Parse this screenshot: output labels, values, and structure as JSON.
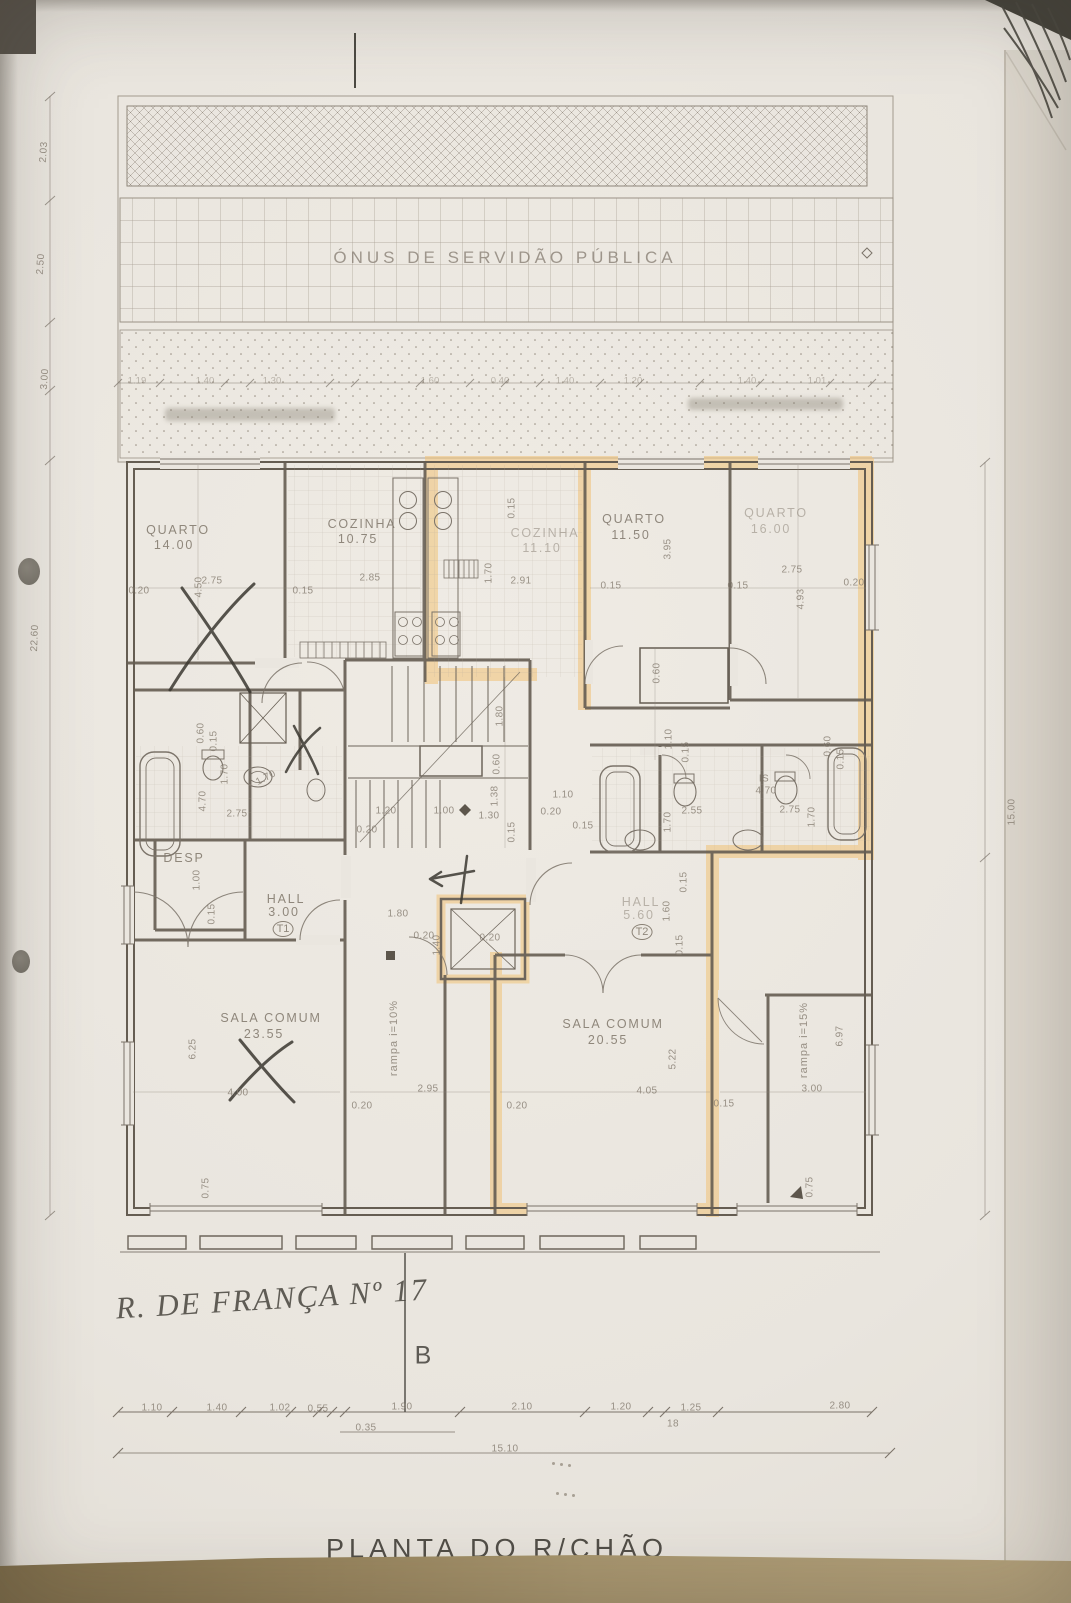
{
  "document": {
    "title": "PLANTA DO R/CHÃO",
    "servitude_band": "ÓNUS DE SERVIDÃO PÚBLICA",
    "handwritten_note": "R. DE FRANÇA Nº 17",
    "section_letter": "B"
  },
  "colors": {
    "highlight": "#f1c277",
    "wall": "#655d52",
    "ink": "#7a7166",
    "pen": "#3b3831",
    "paper": "#eae6df",
    "desk": "#a7946c"
  },
  "plan": {
    "labels": [
      {
        "text": "QUARTO",
        "x": 178,
        "y": 530,
        "cls": "room",
        "name": "room-label-quarto-1"
      },
      {
        "text": "14.00",
        "x": 174,
        "y": 545,
        "cls": "room",
        "name": "room-area-quarto-1"
      },
      {
        "text": "COZINHA",
        "x": 362,
        "y": 524,
        "cls": "room",
        "name": "room-label-cozinha-1"
      },
      {
        "text": "10.75",
        "x": 358,
        "y": 539,
        "cls": "room",
        "name": "room-area-cozinha-1"
      },
      {
        "text": "COZINHA",
        "x": 545,
        "y": 533,
        "cls": "roomf",
        "name": "room-label-cozinha-2"
      },
      {
        "text": "11.10",
        "x": 542,
        "y": 548,
        "cls": "roomf",
        "name": "room-area-cozinha-2"
      },
      {
        "text": "QUARTO",
        "x": 634,
        "y": 519,
        "cls": "room",
        "name": "room-label-quarto-2"
      },
      {
        "text": "11.50",
        "x": 631,
        "y": 535,
        "cls": "room",
        "name": "room-area-quarto-2"
      },
      {
        "text": "QUARTO",
        "x": 776,
        "y": 513,
        "cls": "roomf",
        "name": "room-label-quarto-3"
      },
      {
        "text": "16.00",
        "x": 771,
        "y": 529,
        "cls": "roomf",
        "name": "room-area-quarto-3"
      },
      {
        "text": "DESP",
        "x": 184,
        "y": 858,
        "cls": "room",
        "name": "room-label-desp"
      },
      {
        "text": "HALL",
        "x": 286,
        "y": 899,
        "cls": "room",
        "name": "room-label-hall-t1"
      },
      {
        "text": "3.00",
        "x": 284,
        "y": 912,
        "cls": "room",
        "name": "room-area-hall-t1"
      },
      {
        "text": "T1",
        "x": 283,
        "y": 929,
        "cls": "circ",
        "name": "unit-badge-t1"
      },
      {
        "text": "HALL",
        "x": 641,
        "y": 902,
        "cls": "roomf",
        "name": "room-label-hall-t2"
      },
      {
        "text": "5.60",
        "x": 639,
        "y": 915,
        "cls": "roomf",
        "name": "room-area-hall-t2"
      },
      {
        "text": "T2",
        "x": 642,
        "y": 932,
        "cls": "circ",
        "name": "unit-badge-t2"
      },
      {
        "text": "SALA COMUM",
        "x": 271,
        "y": 1018,
        "cls": "room",
        "name": "room-label-sala-1"
      },
      {
        "text": "23.55",
        "x": 264,
        "y": 1034,
        "cls": "room",
        "name": "room-area-sala-1"
      },
      {
        "text": "SALA COMUM",
        "x": 613,
        "y": 1024,
        "cls": "room",
        "name": "room-label-sala-2"
      },
      {
        "text": "20.55",
        "x": 608,
        "y": 1040,
        "cls": "room",
        "name": "room-area-sala-2"
      },
      {
        "text": "IS",
        "x": 764,
        "y": 779,
        "cls": "dim",
        "name": "room-label-is"
      },
      {
        "text": "4.70",
        "x": 766,
        "y": 791,
        "cls": "dim",
        "name": "room-area-is"
      },
      {
        "text": "rampa i=10%",
        "x": 394,
        "y": 1038,
        "rot": -90,
        "cls": "ramp",
        "name": "ramp-label-left"
      },
      {
        "text": "rampa i=15%",
        "x": 804,
        "y": 1040,
        "rot": -90,
        "cls": "ramp",
        "name": "ramp-label-right"
      },
      {
        "text": "2.03",
        "x": 44,
        "y": 152,
        "rot": -86,
        "cls": "dim"
      },
      {
        "text": "2.50",
        "x": 41,
        "y": 264,
        "rot": -86,
        "cls": "dim"
      },
      {
        "text": "3.00",
        "x": 45,
        "y": 379,
        "rot": -86,
        "cls": "dim"
      },
      {
        "text": "22.60",
        "x": 35,
        "y": 638,
        "rot": -88,
        "cls": "dim"
      },
      {
        "text": "15.00",
        "x": 1012,
        "y": 812,
        "rot": -90,
        "cls": "dim"
      },
      {
        "text": "1.19",
        "x": 137,
        "y": 381,
        "cls": "dimf"
      },
      {
        "text": "1.40",
        "x": 205,
        "y": 381,
        "cls": "dimf"
      },
      {
        "text": "1.30",
        "x": 272,
        "y": 381,
        "cls": "dimf"
      },
      {
        "text": "1.60",
        "x": 430,
        "y": 381,
        "cls": "dimf"
      },
      {
        "text": "0.40",
        "x": 500,
        "y": 381,
        "cls": "dimf"
      },
      {
        "text": "1.40",
        "x": 565,
        "y": 381,
        "cls": "dimf"
      },
      {
        "text": "1.20",
        "x": 633,
        "y": 381,
        "cls": "dimf"
      },
      {
        "text": "1.40",
        "x": 747,
        "y": 381,
        "cls": "dimf"
      },
      {
        "text": "1.01",
        "x": 817,
        "y": 381,
        "cls": "dimf"
      },
      {
        "text": "0.20",
        "x": 139,
        "y": 591,
        "cls": "dim"
      },
      {
        "text": "4.50",
        "x": 199,
        "y": 587,
        "rot": -90,
        "cls": "dim"
      },
      {
        "text": "2.75",
        "x": 212,
        "y": 581,
        "cls": "dim"
      },
      {
        "text": "0.15",
        "x": 303,
        "y": 591,
        "cls": "dim"
      },
      {
        "text": "2.85",
        "x": 370,
        "y": 578,
        "cls": "dim"
      },
      {
        "text": "1.70",
        "x": 489,
        "y": 573,
        "rot": -90,
        "cls": "dim"
      },
      {
        "text": "2.91",
        "x": 521,
        "y": 581,
        "cls": "dim"
      },
      {
        "text": "0.15",
        "x": 512,
        "y": 508,
        "rot": -90,
        "cls": "dim"
      },
      {
        "text": "0.15",
        "x": 611,
        "y": 586,
        "cls": "dim"
      },
      {
        "text": "3.95",
        "x": 668,
        "y": 549,
        "rot": -90,
        "cls": "dim"
      },
      {
        "text": "2.75",
        "x": 792,
        "y": 570,
        "cls": "dim"
      },
      {
        "text": "0.15",
        "x": 738,
        "y": 586,
        "cls": "dim"
      },
      {
        "text": "4.93",
        "x": 801,
        "y": 599,
        "rot": -90,
        "cls": "dim"
      },
      {
        "text": "0.20",
        "x": 854,
        "y": 583,
        "cls": "dim"
      },
      {
        "text": "0.60",
        "x": 657,
        "y": 673,
        "rot": -90,
        "cls": "dim"
      },
      {
        "text": "1.10",
        "x": 669,
        "y": 739,
        "rot": -90,
        "cls": "dim"
      },
      {
        "text": "0.15",
        "x": 686,
        "y": 752,
        "rot": -90,
        "cls": "dim"
      },
      {
        "text": "0.60",
        "x": 201,
        "y": 733,
        "rot": -90,
        "cls": "dim"
      },
      {
        "text": "0.15",
        "x": 214,
        "y": 741,
        "rot": -90,
        "cls": "dim"
      },
      {
        "text": "1.70",
        "x": 225,
        "y": 774,
        "rot": -90,
        "cls": "dim"
      },
      {
        "text": "1.70",
        "x": 266,
        "y": 778,
        "rot": -28,
        "cls": "dim"
      },
      {
        "text": "4.70",
        "x": 203,
        "y": 801,
        "rot": -90,
        "cls": "dim"
      },
      {
        "text": "2.75",
        "x": 237,
        "y": 814,
        "cls": "dim"
      },
      {
        "text": "1.00",
        "x": 197,
        "y": 880,
        "rot": -90,
        "cls": "dim"
      },
      {
        "text": "0.15",
        "x": 212,
        "y": 914,
        "rot": -90,
        "cls": "dim"
      },
      {
        "text": "1.80",
        "x": 500,
        "y": 716,
        "rot": -90,
        "cls": "dim"
      },
      {
        "text": "0.60",
        "x": 497,
        "y": 764,
        "rot": -90,
        "cls": "dim"
      },
      {
        "text": "1.38",
        "x": 495,
        "y": 796,
        "rot": -90,
        "cls": "dim"
      },
      {
        "text": "0.15",
        "x": 512,
        "y": 832,
        "rot": -90,
        "cls": "dim"
      },
      {
        "text": "1.20",
        "x": 386,
        "y": 811,
        "cls": "dim"
      },
      {
        "text": "1.00",
        "x": 444,
        "y": 811,
        "cls": "dim"
      },
      {
        "text": "1.30",
        "x": 489,
        "y": 816,
        "cls": "dim"
      },
      {
        "text": "0.20",
        "x": 367,
        "y": 830,
        "cls": "dim"
      },
      {
        "text": "1.80",
        "x": 398,
        "y": 914,
        "cls": "dim"
      },
      {
        "text": "0.20",
        "x": 424,
        "y": 936,
        "cls": "dim"
      },
      {
        "text": "1.40",
        "x": 437,
        "y": 945,
        "rot": -90,
        "cls": "dim"
      },
      {
        "text": "0.20",
        "x": 490,
        "y": 938,
        "cls": "dim"
      },
      {
        "text": "1.10",
        "x": 563,
        "y": 795,
        "cls": "dim"
      },
      {
        "text": "0.20",
        "x": 551,
        "y": 812,
        "cls": "dim"
      },
      {
        "text": "2.55",
        "x": 692,
        "y": 811,
        "cls": "dim"
      },
      {
        "text": "1.70",
        "x": 668,
        "y": 822,
        "rot": -90,
        "cls": "dim"
      },
      {
        "text": "0.15",
        "x": 583,
        "y": 826,
        "cls": "dim"
      },
      {
        "text": "2.75",
        "x": 790,
        "y": 810,
        "cls": "dim"
      },
      {
        "text": "1.70",
        "x": 812,
        "y": 817,
        "rot": -90,
        "cls": "dim"
      },
      {
        "text": "0.60",
        "x": 828,
        "y": 746,
        "rot": -90,
        "cls": "dim"
      },
      {
        "text": "0.15",
        "x": 841,
        "y": 759,
        "rot": -90,
        "cls": "dim"
      },
      {
        "text": "1.60",
        "x": 667,
        "y": 911,
        "rot": -90,
        "cls": "dim"
      },
      {
        "text": "0.15",
        "x": 684,
        "y": 882,
        "rot": -90,
        "cls": "dim"
      },
      {
        "text": "0.15",
        "x": 680,
        "y": 945,
        "rot": -90,
        "cls": "dim"
      },
      {
        "text": "6.25",
        "x": 193,
        "y": 1049,
        "rot": -90,
        "cls": "dim"
      },
      {
        "text": "4.00",
        "x": 238,
        "y": 1093,
        "cls": "dim"
      },
      {
        "text": "0.75",
        "x": 206,
        "y": 1188,
        "rot": -90,
        "cls": "dim"
      },
      {
        "text": "2.95",
        "x": 428,
        "y": 1089,
        "cls": "dim"
      },
      {
        "text": "0.20",
        "x": 362,
        "y": 1106,
        "cls": "dim"
      },
      {
        "text": "5.22",
        "x": 673,
        "y": 1059,
        "rot": -90,
        "cls": "dim"
      },
      {
        "text": "4.05",
        "x": 647,
        "y": 1091,
        "cls": "dim"
      },
      {
        "text": "0.20",
        "x": 517,
        "y": 1106,
        "cls": "dim"
      },
      {
        "text": "0.15",
        "x": 724,
        "y": 1104,
        "cls": "dim"
      },
      {
        "text": "3.00",
        "x": 812,
        "y": 1089,
        "cls": "dim"
      },
      {
        "text": "6.97",
        "x": 840,
        "y": 1036,
        "rot": -90,
        "cls": "dim"
      },
      {
        "text": "0.75",
        "x": 810,
        "y": 1187,
        "rot": -90,
        "cls": "dim"
      },
      {
        "text": "1.10",
        "x": 152,
        "y": 1408,
        "cls": "dim"
      },
      {
        "text": "1.40",
        "x": 217,
        "y": 1408,
        "cls": "dim"
      },
      {
        "text": "1.02",
        "x": 280,
        "y": 1408,
        "cls": "dim"
      },
      {
        "text": "0.55",
        "x": 318,
        "y": 1409,
        "cls": "dim"
      },
      {
        "text": "1.90",
        "x": 402,
        "y": 1407,
        "cls": "dim"
      },
      {
        "text": "2.10",
        "x": 522,
        "y": 1407,
        "cls": "dim"
      },
      {
        "text": "1.20",
        "x": 621,
        "y": 1407,
        "cls": "dim"
      },
      {
        "text": "1.25",
        "x": 691,
        "y": 1408,
        "cls": "dim"
      },
      {
        "text": "2.80",
        "x": 840,
        "y": 1406,
        "cls": "dim"
      },
      {
        "text": "0.35",
        "x": 366,
        "y": 1428,
        "cls": "dim"
      },
      {
        "text": "18",
        "x": 673,
        "y": 1424,
        "cls": "dim"
      },
      {
        "text": "15.10",
        "x": 505,
        "y": 1449,
        "cls": "dim"
      }
    ]
  }
}
